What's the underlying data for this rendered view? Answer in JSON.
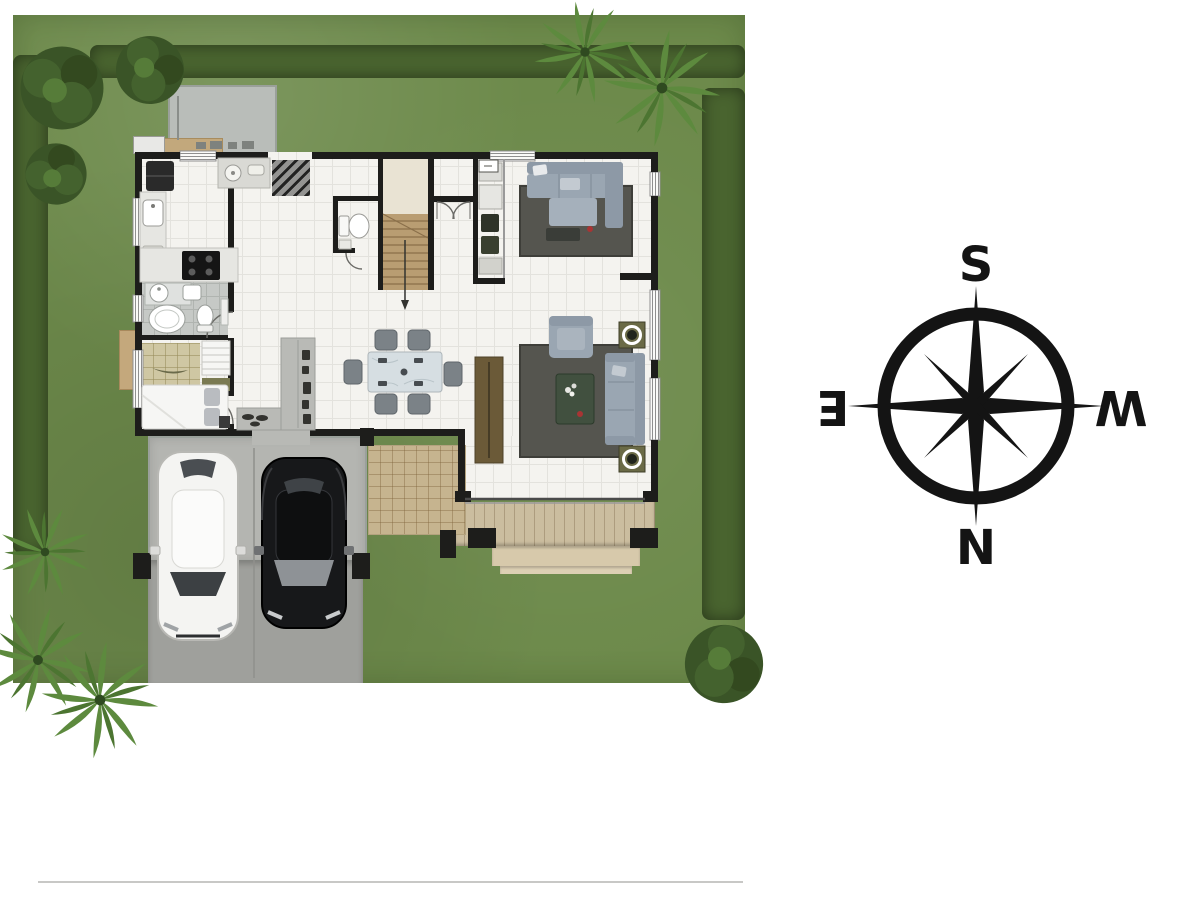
{
  "compass": {
    "top_label": "S",
    "bottom_label": "N",
    "left_label": "E",
    "right_label": "W",
    "left_label_rotated_180": true,
    "right_label_rotated_180": true
  },
  "colors": {
    "lawn": "#6d8a4b",
    "hedge": "#49642f",
    "tree_dark": "#3a5427",
    "palm": "#5d8a3e",
    "driveway": "#9fa09c",
    "garage_slab": "#b4b5b1",
    "wall": "#1d1d1b",
    "floor": "#f4f3ef",
    "wood_stairs": "#b99d72",
    "deck": "#cbbd9f",
    "deck_step": "#d7c9ab",
    "patio": "#c6b48f",
    "service_slab": "#b9bdb9",
    "rug": "#55554f",
    "sofa": "#9aa6b2",
    "hall_counter": "#b9bab6",
    "kitchen_counter": "#e6e6e2",
    "bathroom_tile": "#c6c9c6",
    "tatami": "#cfc7a3",
    "bed": "#f6f6f4",
    "dining_table": "#d6dee2",
    "chair": "#7b8287",
    "console_wood": "#6b5a38",
    "car_white": "#f4f4f2",
    "car_black": "#17181a",
    "glass_dark": "#3c4043",
    "planter_pot": "#6a6a46",
    "accent_red": "#a83434",
    "compass_ink": "#141414",
    "baseline_rule": "#c8c8c6"
  },
  "plan": {
    "rooms": [
      "kitchen",
      "entry-hall",
      "wc",
      "staircase",
      "family-room",
      "bathroom",
      "bedroom",
      "dining-area",
      "living-room",
      "garage"
    ],
    "furniture": [
      "refrigerator",
      "kitchen-sink",
      "cooktop",
      "basin-cabinet",
      "toilet",
      "stairs",
      "storage-shelf",
      "sectional-sofa",
      "area-rug",
      "vanity-sinks",
      "bathtub",
      "bed",
      "tatami-mat",
      "ladder-shelf",
      "dining-table",
      "dining-chairs",
      "hall-console",
      "tv-console",
      "armchair",
      "sofa",
      "coffee-table",
      "plant-pots"
    ],
    "vehicles": [
      "white-car",
      "black-car"
    ],
    "landscape": [
      "lawn",
      "hedge-top",
      "hedge-left",
      "hedge-right",
      "bushy-trees",
      "palm-trees",
      "corner-bush",
      "driveway",
      "wood-deck",
      "wood-patio",
      "service-slab"
    ]
  }
}
